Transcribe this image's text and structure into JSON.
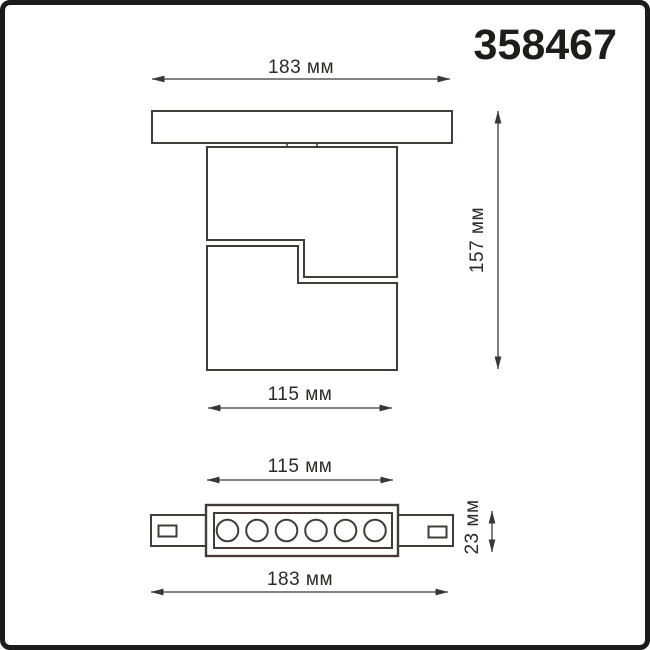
{
  "product": {
    "article": "358467"
  },
  "colors": {
    "background": "#ffffff",
    "frame_border": "#1b1b1b",
    "drawing_line": "#413c3a",
    "dimension_line": "#3a3836",
    "text": "#2b2a28"
  },
  "views": {
    "front": {
      "name": "front-view-with-track",
      "overall_width_label": "183 мм",
      "overall_height_label": "157 мм",
      "body_width_label": "115 мм"
    },
    "bottom": {
      "name": "bottom-view-led-module",
      "module_width_label": "115 мм",
      "overall_width_label": "183 мм",
      "module_height_label": "23 мм",
      "led_count": 6
    }
  }
}
